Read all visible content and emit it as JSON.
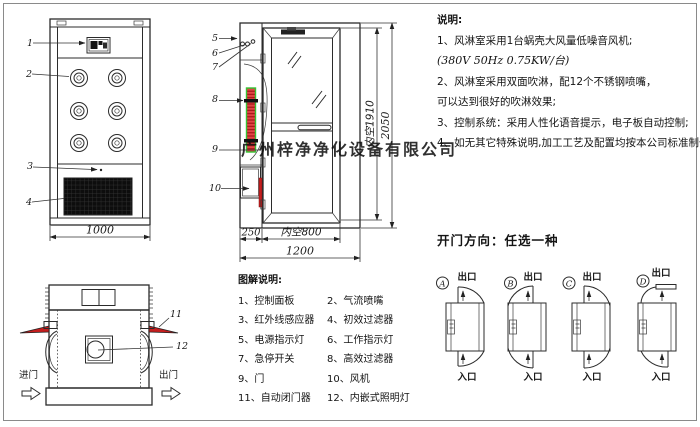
{
  "sheet": {
    "watermark": "广州梓净净化设备有限公司"
  },
  "notes": {
    "title": "说明:",
    "lines": [
      "1、风淋室采用1台蜗壳大风量低噪音风机;",
      "(380V  50Hz  0.75KW/台)",
      "2、风淋室采用双面吹淋，配12个不锈钢喷嘴，",
      "可以达到很好的吹淋效果;",
      "3、控制系统：采用人性化语音提示，电子板自动控制;",
      "4、如无其它特殊说明,加工工艺及配置均按本公司标准制作。"
    ]
  },
  "door_directions": {
    "title": "开门方向：任选一种",
    "options": [
      {
        "letter": "A",
        "exit": "出口",
        "entry": "入口"
      },
      {
        "letter": "B",
        "exit": "出口",
        "entry": "入口"
      },
      {
        "letter": "C",
        "exit": "出口",
        "entry": "入口"
      },
      {
        "letter": "D",
        "exit": "出口",
        "entry": "入口"
      }
    ]
  },
  "legend": {
    "title": "图解说明:",
    "items": [
      "1、控制面板",
      "2、气流喷嘴",
      "3、红外线感应器",
      "4、初效过滤器",
      "5、电源指示灯",
      "6、工作指示灯",
      "7、急停开关",
      "8、高效过滤器",
      "9、门",
      "10、风机",
      "11、自动闭门器",
      "12、内嵌式照明灯"
    ]
  },
  "front_view": {
    "part_labels": [
      "1",
      "2",
      "3",
      "4"
    ],
    "dim_width": "1000"
  },
  "side_view": {
    "part_labels": [
      "5",
      "6",
      "7",
      "8",
      "9",
      "10"
    ],
    "dim_left_section": "250",
    "dim_inner_width": "内空800",
    "dim_total_width": "1200",
    "dim_inner_height": "内空1910",
    "dim_total_height": "2050"
  },
  "top_view": {
    "part_labels": [
      "11",
      "12"
    ],
    "entry_label": "进门",
    "exit_label": "出门"
  },
  "colors": {
    "line": "#2b2b2b",
    "filter_red": "#d42020",
    "filter_green": "#35c435",
    "closer_red": "#c41e1e"
  }
}
